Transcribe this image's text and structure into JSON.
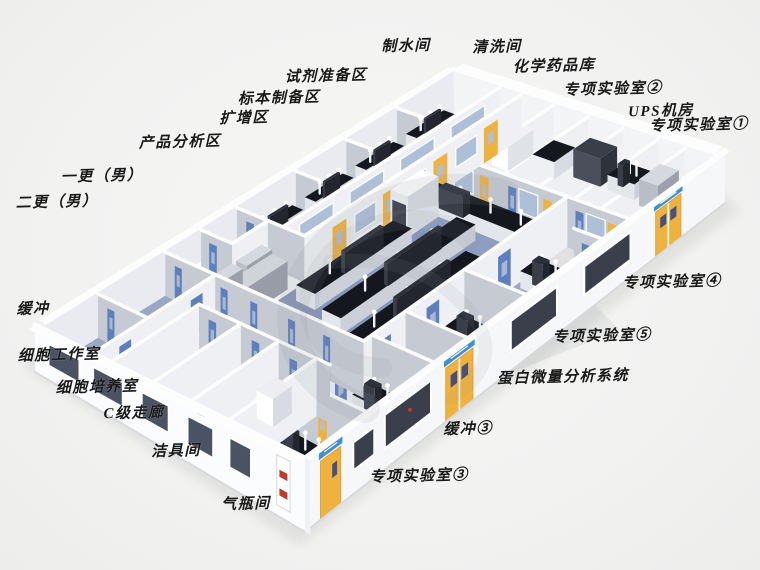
{
  "diagram": {
    "type": "isometric-laboratory-floor-plan",
    "background": "#f2f2f1",
    "palette": {
      "wall_white": "#fbfcfd",
      "wall_face_lit": "#eef0f3",
      "wall_face_shaded": "#c6cad3",
      "back_wall_left": "#e9ebf0",
      "back_wall_right": "#f3f4f6",
      "floor_lab": "#8e9ec0",
      "floor_room": "#9aa8c4",
      "floor_room_mid": "#aab6cc",
      "floor_room_light": "#c2c9d6",
      "floor_corridor": "#ccd2de",
      "bench_top": "#15171f",
      "bench_body": "#e3e6eb",
      "door_yellow": "#f0b23e",
      "door_blue": "#5d7fbd",
      "door_sign_blue": "#3f8fd2",
      "window_front_dark": "#3a3f4b",
      "window_front_blue": "#4a5263",
      "glass_blue": "#aebfd8",
      "sign_red": "#c0392b",
      "watermark": "#8b919d",
      "label_text": "#191919"
    },
    "room_labels": [
      {
        "text": "制水间",
        "x": 406,
        "y": 45
      },
      {
        "text": "清洗间",
        "x": 497,
        "y": 46
      },
      {
        "text": "化学药品库",
        "x": 554,
        "y": 65
      },
      {
        "text": "专项实验室②",
        "x": 613,
        "y": 88
      },
      {
        "text": "UPS机房",
        "x": 661,
        "y": 110
      },
      {
        "text": "专项实验室①",
        "x": 699,
        "y": 124
      },
      {
        "text": "试剂准备区",
        "x": 326,
        "y": 75
      },
      {
        "text": "标本制备区",
        "x": 279,
        "y": 97
      },
      {
        "text": "扩增区",
        "x": 244,
        "y": 117
      },
      {
        "text": "产品分析区",
        "x": 180,
        "y": 141
      },
      {
        "text": "一更（男）",
        "x": 102,
        "y": 175
      },
      {
        "text": "二更（男）",
        "x": 57,
        "y": 201
      },
      {
        "text": "缓冲",
        "x": 33,
        "y": 308
      },
      {
        "text": "细胞工作室",
        "x": 59,
        "y": 354
      },
      {
        "text": "细胞培养室",
        "x": 97,
        "y": 386
      },
      {
        "text": "C级走廊",
        "x": 134,
        "y": 412
      },
      {
        "text": "洁具间",
        "x": 176,
        "y": 450
      },
      {
        "text": "气瓶间",
        "x": 246,
        "y": 503
      },
      {
        "text": "专项实验室③",
        "x": 419,
        "y": 475
      },
      {
        "text": "缓冲③",
        "x": 468,
        "y": 428
      },
      {
        "text": "蛋白微量分析系统",
        "x": 563,
        "y": 376
      },
      {
        "text": "专项实验室⑤",
        "x": 602,
        "y": 335
      },
      {
        "text": "专项实验室④",
        "x": 672,
        "y": 281
      }
    ]
  }
}
